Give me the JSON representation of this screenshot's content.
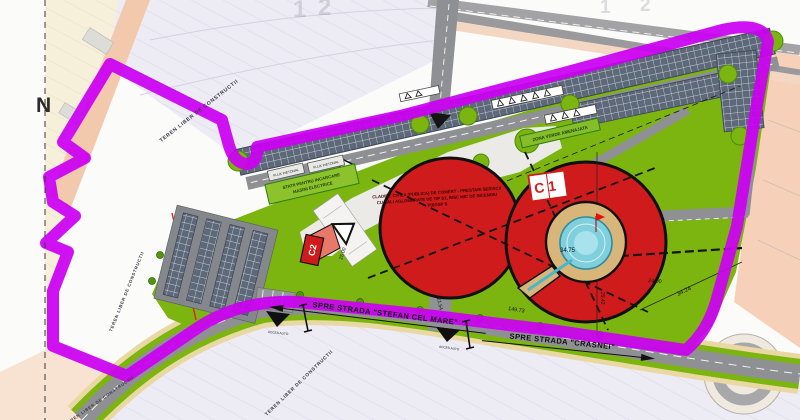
{
  "plan": {
    "north_label": "N",
    "parcel_numbers": {
      "p1": "1",
      "p2": "2"
    },
    "streets": {
      "stefan": "SPRE STRADA \"STEFAN CEL MARE\"",
      "crasnei": "SPRE STRADA \"CRASNEI\""
    },
    "zones": {
      "teren_liber": "TEREN LIBER DE CONSTRUCTII",
      "zona_verde": "ZONA VERDE AMENAJATA"
    },
    "buildings": {
      "c1_code": "C1",
      "c1_desc1": "CLADIRE CIVILA (PUBLICA) DE COMERT - PRESTARI SERVICII",
      "c1_desc2": "CU SALI AGLOMERATE DE TIP S1, RISC MIC DE INCENDIU",
      "c1_desc3": "P(I)GSP S",
      "c2_code": "C2"
    },
    "features": {
      "ev_line1": "STATII PENTRU INCARCARE",
      "ev_line2": "MASINI ELECTRICE",
      "flux": "FLUX PIETONAL",
      "acces": "ACCES AUTO"
    },
    "dimensions": {
      "pool": "34.75",
      "axis": "24.00",
      "east": "34.24",
      "south": "149.73",
      "drive": "21.54",
      "c2": "25.00",
      "vert": "29.42"
    },
    "colors": {
      "boundary": "#cb00f2",
      "building": "#cf1b1b",
      "green": "#7cb410",
      "pool": "#7fcfdd",
      "sand": "#d8b579",
      "road": "#8f9093"
    }
  }
}
